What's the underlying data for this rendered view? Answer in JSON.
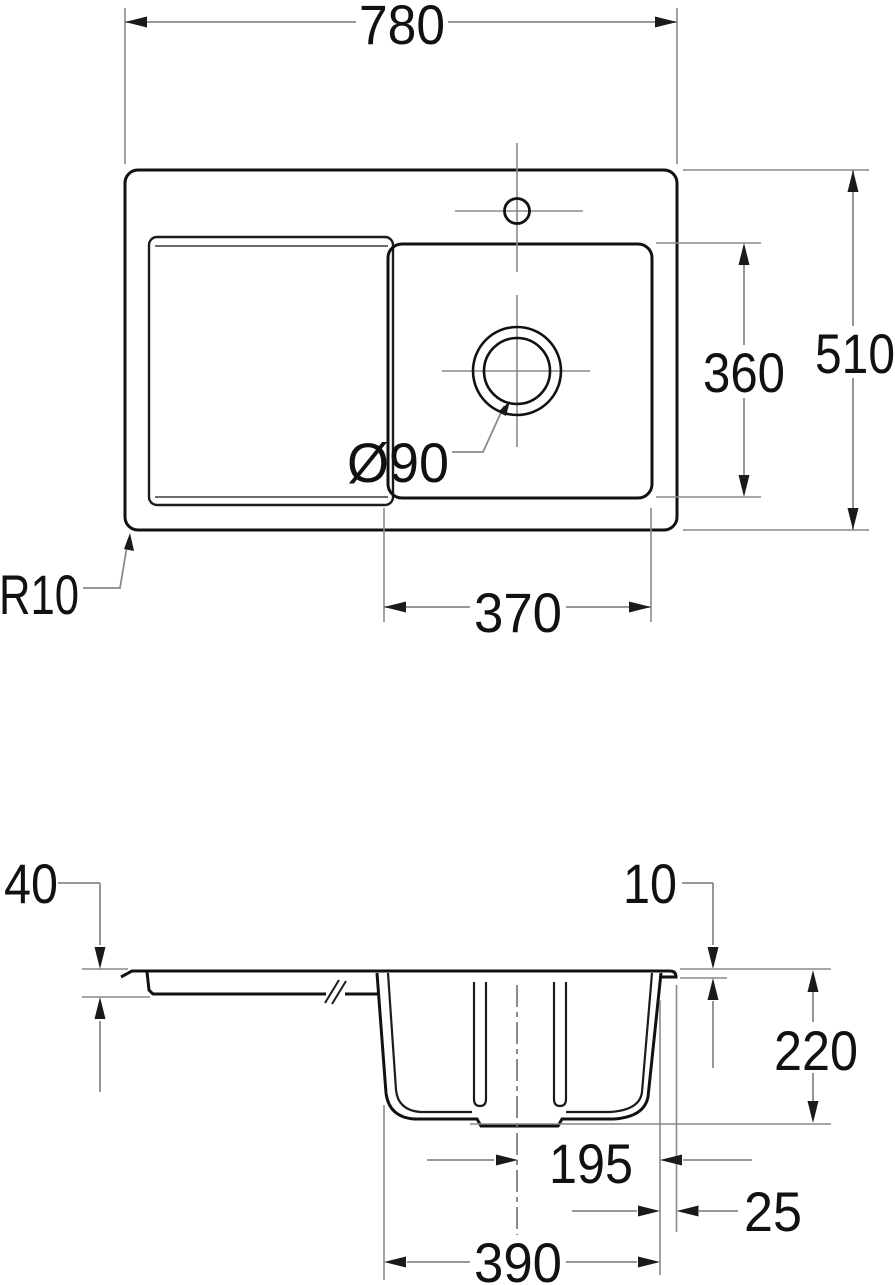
{
  "drawing": {
    "title": "Kitchen sink installation drawing",
    "units": "mm",
    "colors": {
      "background": "#ffffff",
      "geometry_line": "#111111",
      "dimension_line": "#8a8a8a",
      "text": "#111111"
    },
    "top_view": {
      "dim_overall_width": "780",
      "dim_overall_depth": "510",
      "dim_bowl_depth": "360",
      "dim_bowl_width": "370",
      "drain_diameter": "Ø90",
      "corner_radius": "R10"
    },
    "section_view": {
      "dim_rim_height_left": "40",
      "dim_rim_height_right": "10",
      "dim_bowl_height": "220",
      "dim_drain_center_to_edge": "195",
      "dim_edge_gap": "25",
      "dim_bowl_outer_width": "390"
    }
  }
}
